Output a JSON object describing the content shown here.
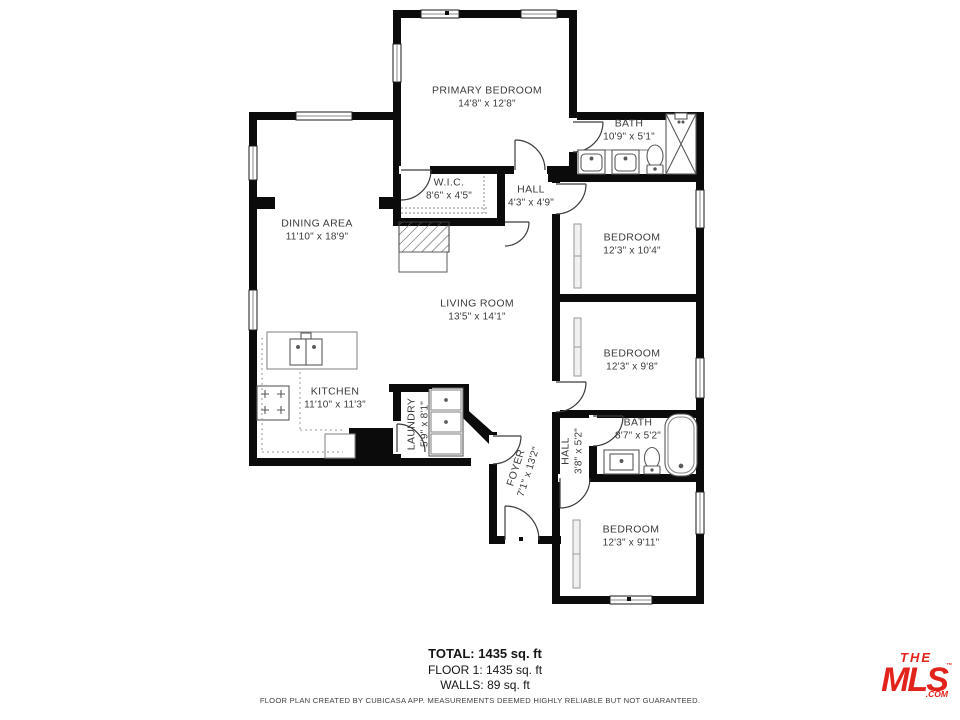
{
  "plan": {
    "rooms": [
      {
        "name": "PRIMARY BEDROOM",
        "dims": "14'8\" x 12'8\""
      },
      {
        "name": "BATH",
        "dims": "10'9\" x 5'1\""
      },
      {
        "name": "W.I.C.",
        "dims": "8'6\" x 4'5\""
      },
      {
        "name": "HALL",
        "dims": "4'3\" x 4'9\""
      },
      {
        "name": "DINING AREA",
        "dims": "11'10\" x 18'9\""
      },
      {
        "name": "BEDROOM",
        "dims": "12'3\" x 10'4\""
      },
      {
        "name": "LIVING ROOM",
        "dims": "13'5\" x 14'1\""
      },
      {
        "name": "BEDROOM",
        "dims": "12'3\" x 9'8\""
      },
      {
        "name": "KITCHEN",
        "dims": "11'10\" x 11'3\""
      },
      {
        "name": "LAUNDRY",
        "dims": "5'9\" x 8'1\""
      },
      {
        "name": "FOYER",
        "dims": "7'1\" x 13'2\""
      },
      {
        "name": "HALL",
        "dims": "3'8\" x 5'2\""
      },
      {
        "name": "BATH",
        "dims": "8'7\" x 5'2\""
      },
      {
        "name": "BEDROOM",
        "dims": "12'3\" x 9'11\""
      }
    ],
    "summary": {
      "total": "TOTAL: 1435 sq. ft",
      "floor1": "FLOOR 1: 1435 sq. ft",
      "walls": "WALLS: 89 sq. ft"
    },
    "disclaimer": "FLOOR PLAN CREATED BY CUBICASA APP. MEASUREMENTS DEEMED HIGHLY RELIABLE BUT NOT GUARANTEED.",
    "logo": {
      "the": "THE",
      "mls": "MLS",
      "tm": "™",
      "com": ".COM"
    },
    "fixtures": [
      "shower",
      "double-sink-vanity",
      "toilet",
      "bathtub",
      "stove",
      "island-sink",
      "washer-dryer",
      "sliding-closet-door",
      "door-arc",
      "window"
    ],
    "colors": {
      "walls": "#0b0b0b",
      "fixtures": "#5a5a5a",
      "labels": "#3b3b3b",
      "logo_red": "#e2231b"
    }
  }
}
